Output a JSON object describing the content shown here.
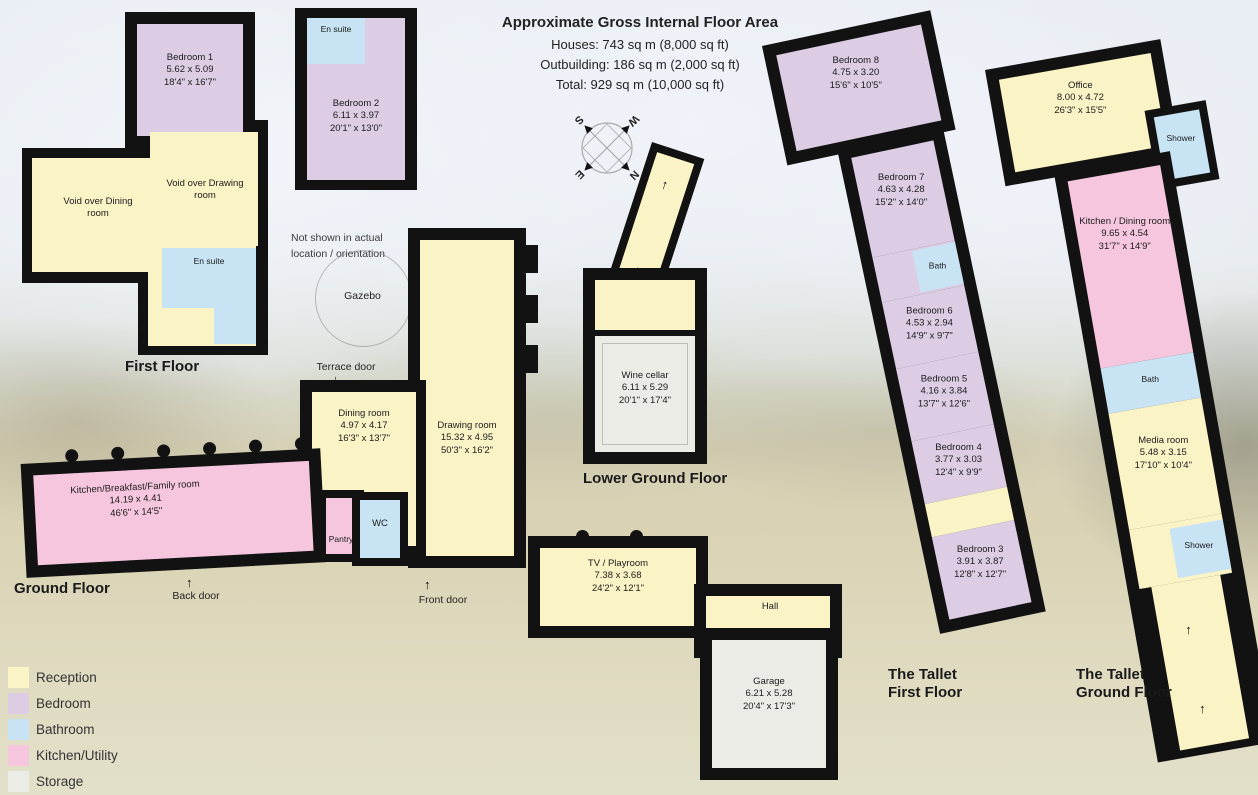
{
  "header": {
    "title": "Approximate Gross Internal Floor Area",
    "line1": "Houses: 743 sq m (8,000 sq ft)",
    "line2": "Outbuilding: 186 sq m (2,000 sq ft)",
    "line3": "Total: 929 sq m (10,000 sq ft)"
  },
  "floors": {
    "first": "First Floor",
    "ground": "Ground Floor",
    "lower_ground": "Lower Ground Floor",
    "tallet_first_line1": "The Tallet",
    "tallet_first_line2": "First Floor",
    "tallet_ground_line1": "The Tallet",
    "tallet_ground_line2": "Ground Floor"
  },
  "rooms": {
    "bedroom1": {
      "name": "Bedroom 1",
      "metric": "5.62 x 5.09",
      "imperial": "18'4\" x 16'7\""
    },
    "bedroom2": {
      "name": "Bedroom 2",
      "metric": "6.11 x 3.97",
      "imperial": "20'1\" x 13'0\""
    },
    "void_dining": {
      "name": "Void over Dining room"
    },
    "void_drawing": {
      "name": "Void over Drawing room"
    },
    "dining": {
      "name": "Dining room",
      "metric": "4.97 x 4.17",
      "imperial": "16'3\" x 13'7\""
    },
    "drawing": {
      "name": "Drawing room",
      "metric": "15.32 x 4.95",
      "imperial": "50'3\" x 16'2\""
    },
    "kitchen_main": {
      "name": "Kitchen/Breakfast/Family room",
      "metric": "14.19 x 4.41",
      "imperial": "46'6\" x 14'5\""
    },
    "tv_playroom": {
      "name": "TV / Playroom",
      "metric": "7.38 x 3.68",
      "imperial": "24'2\" x 12'1\""
    },
    "garage": {
      "name": "Garage",
      "metric": "6.21 x 5.28",
      "imperial": "20'4\" x 17'3\""
    },
    "wine_cellar": {
      "name": "Wine cellar",
      "metric": "6.11 x 5.29",
      "imperial": "20'1\" x 17'4\""
    },
    "bedroom8": {
      "name": "Bedroom 8",
      "metric": "4.75 x 3.20",
      "imperial": "15'6\" x 10'5\""
    },
    "bedroom7": {
      "name": "Bedroom 7",
      "metric": "4.63 x 4.28",
      "imperial": "15'2\" x 14'0\""
    },
    "bedroom6": {
      "name": "Bedroom 6",
      "metric": "4.53 x 2.94",
      "imperial": "14'9\" x 9'7\""
    },
    "bedroom5": {
      "name": "Bedroom 5",
      "metric": "4.16 x 3.84",
      "imperial": "13'7\" x 12'6\""
    },
    "bedroom4": {
      "name": "Bedroom 4",
      "metric": "3.77 x 3.03",
      "imperial": "12'4\" x 9'9\""
    },
    "bedroom3": {
      "name": "Bedroom 3",
      "metric": "3.91 x 3.87",
      "imperial": "12'8\" x 12'7\""
    },
    "office": {
      "name": "Office",
      "metric": "8.00 x 4.72",
      "imperial": "26'3\" x 15'5\""
    },
    "kitchen_dining": {
      "name": "Kitchen / Dining room",
      "metric": "9.65 x 4.54",
      "imperial": "31'7\" x 14'9\""
    },
    "media_room": {
      "name": "Media room",
      "metric": "5.48 x 3.15",
      "imperial": "17'10\" x 10'4\""
    }
  },
  "labels": {
    "en_suite": "En suite",
    "pantry": "Pantry",
    "wc": "WC",
    "hall": "Hall",
    "bath": "Bath",
    "shower": "Shower"
  },
  "annotations": {
    "gazebo": "Gazebo",
    "terrace_door": "Terrace door",
    "back_door": "Back door",
    "front_door": "Front door",
    "not_shown_line1": "Not shown in actual",
    "not_shown_line2": "location / orientation"
  },
  "compass": {
    "n": "N",
    "e": "E",
    "s": "S",
    "w": "W"
  },
  "legend": {
    "items": [
      {
        "label": "Reception",
        "color": "#faf3c5"
      },
      {
        "label": "Bedroom",
        "color": "#dccde4"
      },
      {
        "label": "Bathroom",
        "color": "#c7e3f4"
      },
      {
        "label": "Kitchen/Utility",
        "color": "#f5c6de"
      },
      {
        "label": "Storage",
        "color": "#ececE7"
      }
    ]
  }
}
